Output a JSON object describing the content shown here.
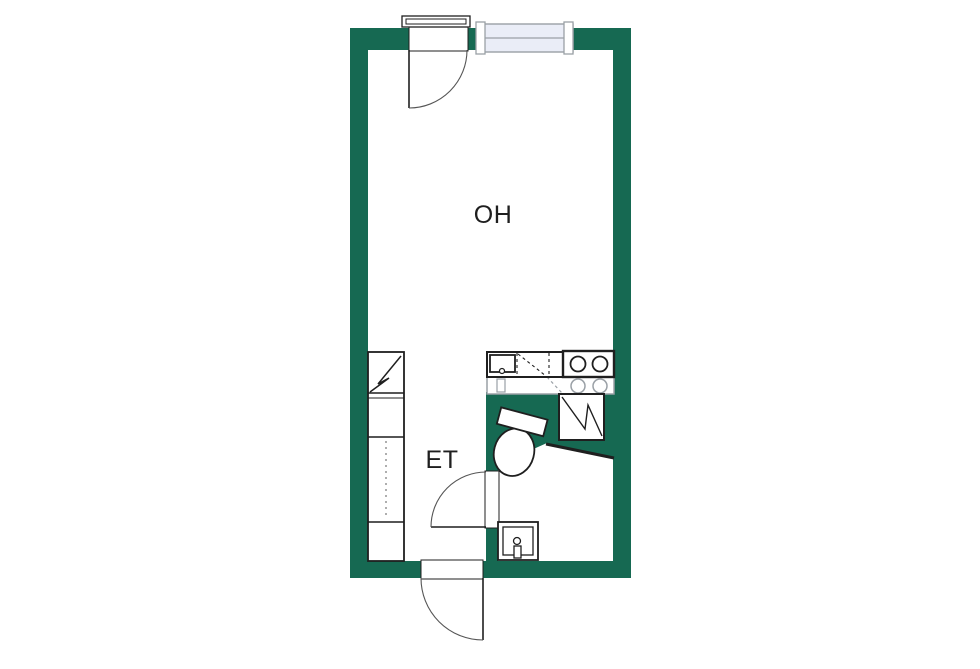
{
  "rooms": {
    "living": {
      "label": "OH"
    },
    "hall": {
      "label": "ET"
    }
  },
  "colors": {
    "wall": "#166952",
    "line": "#1f1f1f",
    "muted_line": "#9aa0a6",
    "window_fill": "#eaedf7",
    "arc": "#555555",
    "background": "#ffffff"
  },
  "icons": {
    "refrigerator-icon": "square-with-zigzag",
    "shower-icon": "square-with-zigzag",
    "stove-icon": "four-burner-circles",
    "kitchen-sink-icon": "basin-with-faucet",
    "washbasin-icon": "nested-rect-with-faucet",
    "toilet-icon": "tank-and-bowl",
    "wardrobe-icon": "rect-with-dashed-line",
    "window-icon": "double-pane-strip",
    "door-icon": "leaf-with-swing-arc"
  }
}
